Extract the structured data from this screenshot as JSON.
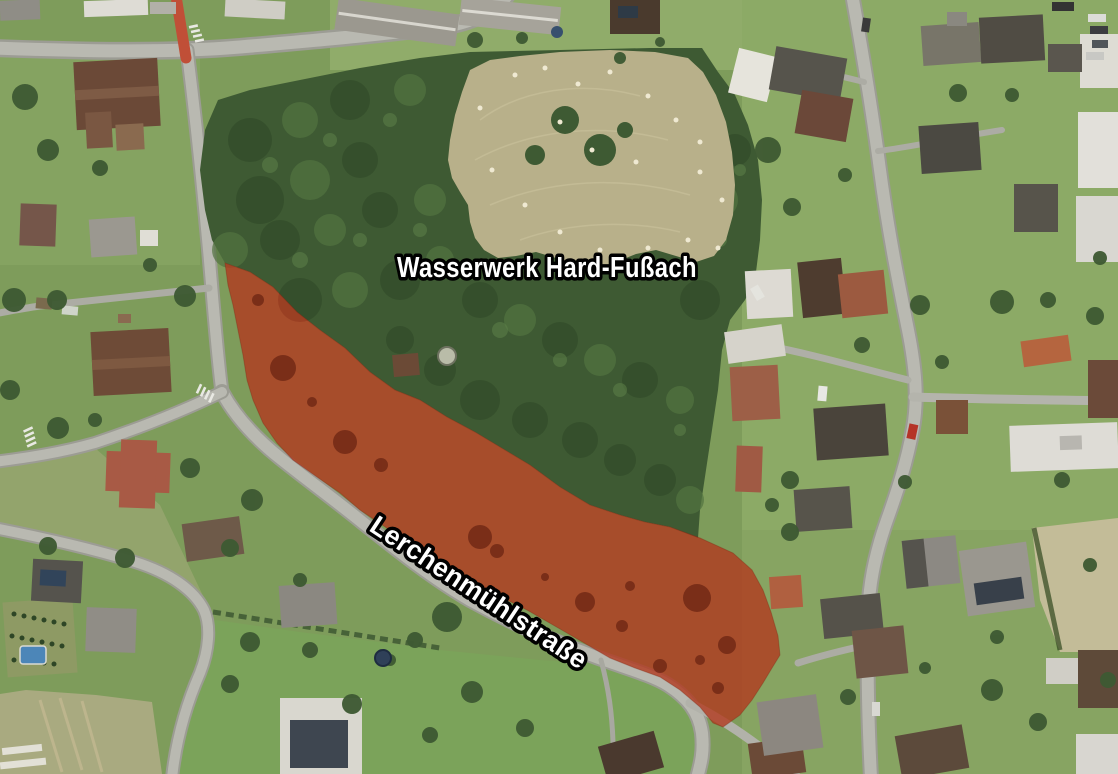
{
  "map": {
    "imagery": "aerial-photo",
    "labels": {
      "site": {
        "text": "Wasserwerk Hard-Fußach",
        "color": "#ffffff",
        "outline": "#000000"
      },
      "street": {
        "text": "Lerchenmühlstraße",
        "color": "#ffffff",
        "outline": "#000000",
        "rotation_deg": 33.5
      }
    },
    "highlight": {
      "name": "marked-parcel",
      "fill": "#B23A1F",
      "opacity": 0.8
    }
  }
}
